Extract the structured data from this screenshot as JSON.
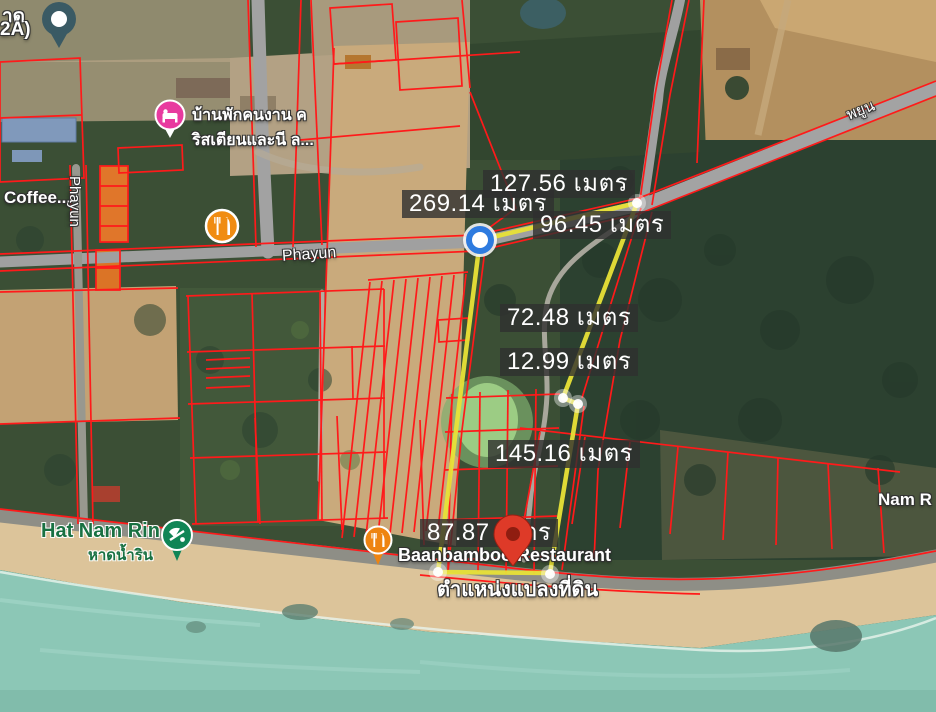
{
  "map": {
    "kind": "satellite-cadastral-map",
    "colors": {
      "parcel_line": "#ff1a1a",
      "highlight_polygon": "#e8e237",
      "measurement_bg": "#303030",
      "measurement_text": "#ffffff",
      "vertex_marker_blue": "#2e7bdf",
      "location_pin_red": "#de3a28",
      "poi_pink": "#e83a9f",
      "poi_orange": "#f08c12",
      "poi_green": "#108556",
      "poi_teal": "#3a5a64",
      "sea": "#8cc7b6",
      "sand": "#dcc49a"
    }
  },
  "measurements": [
    "269.14 เมตร",
    "127.56 เมตร",
    "96.45 เมตร",
    "72.48 เมตร",
    "12.99 เมตร",
    "145.16 เมตร",
    "87.87 เมตร"
  ],
  "parcel": {
    "pin_label": "ตำแหน่งแปลงที่ดิน"
  },
  "pois": {
    "lodging_line1": "บ้านพักคนงาน ค",
    "lodging_line2": "ริสเตียนและนี ล...",
    "coffee": "Coffee...",
    "hat_nam_rin_en": "Hat Nam Rin",
    "hat_nam_rin_th": "หาดน้ำริน",
    "restaurant": "Baanbamboo Restaurant",
    "nam_rin_partial": "Nam R",
    "top_left_line1": "าด",
    "top_left_line2": "2A)"
  },
  "roads": {
    "phayun": "Phayun",
    "phayun_vertical": "Phayun",
    "phayun_thai": "พยูน"
  }
}
